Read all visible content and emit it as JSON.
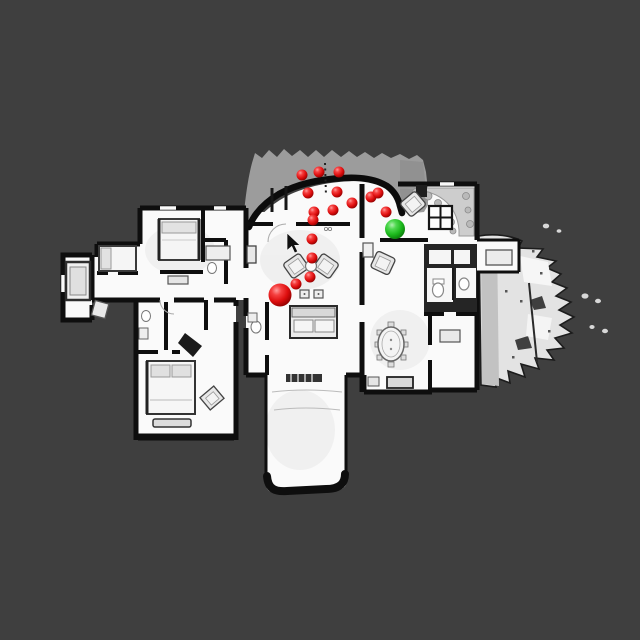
{
  "scene": {
    "colors": {
      "background": "#3f3f3f",
      "floor": "#fafafa",
      "wall": "#0e0e0e",
      "porch_gray": "#9c9c9c",
      "terrain_gray": "#e3e3e3",
      "waypoint_red": "#e01010",
      "goal_green": "#22c022"
    },
    "markers": {
      "waypoint_radius": 5.5,
      "waypoints": [
        {
          "x": 302,
          "y": 175
        },
        {
          "x": 319,
          "y": 172
        },
        {
          "x": 339,
          "y": 172
        },
        {
          "x": 308,
          "y": 193
        },
        {
          "x": 337,
          "y": 192
        },
        {
          "x": 352,
          "y": 203
        },
        {
          "x": 333,
          "y": 210
        },
        {
          "x": 314,
          "y": 212
        },
        {
          "x": 313,
          "y": 220
        },
        {
          "x": 371,
          "y": 197
        },
        {
          "x": 378,
          "y": 193
        },
        {
          "x": 386,
          "y": 212
        },
        {
          "x": 312,
          "y": 239
        },
        {
          "x": 312,
          "y": 258
        },
        {
          "x": 310,
          "y": 277
        },
        {
          "x": 296,
          "y": 284
        }
      ],
      "start": {
        "x": 280,
        "y": 295,
        "r": 11.5
      },
      "goal": {
        "x": 395,
        "y": 229,
        "r": 10
      }
    },
    "cursor": {
      "x": 287,
      "y": 233
    }
  }
}
